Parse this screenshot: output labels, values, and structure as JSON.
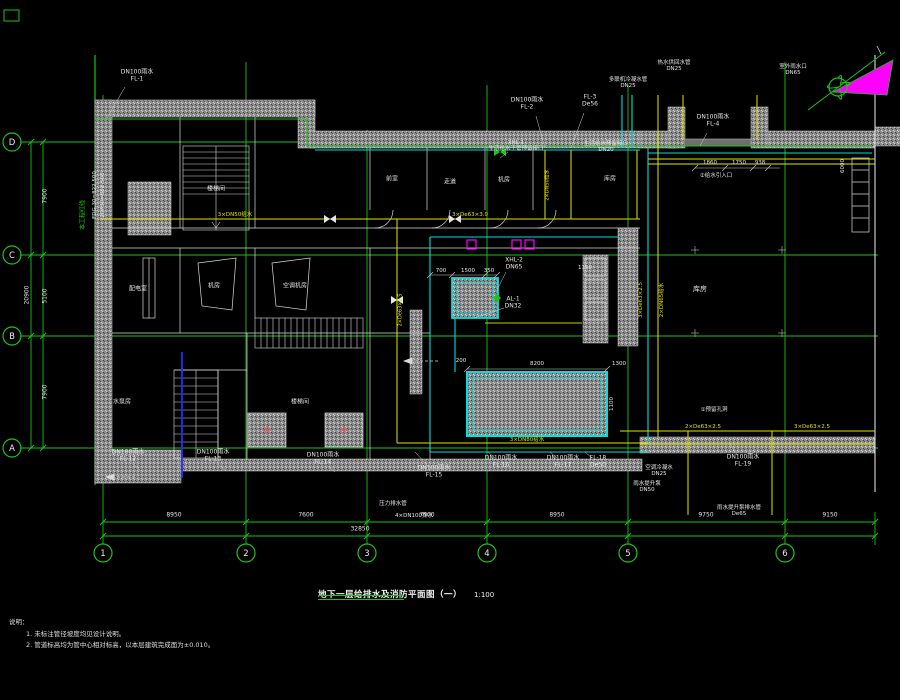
{
  "meta": {
    "title": "地下一层给排水及消防平面图（一）",
    "scale": "1:100"
  },
  "notes": {
    "heading": "说明：",
    "items": [
      "1. 未标注管径坡度均见设计说明。",
      "2. 管道标高均为管中心相对标高，以本层建筑完成面为±0.010。"
    ]
  },
  "colors": {
    "grid": "#19c519",
    "pipe_water": "#00e0e0",
    "pipe_fire": "#e3e300",
    "wall": "#8f8f8f",
    "north": "#ff00ff",
    "text": "#e6e6e6"
  },
  "grid": {
    "cols": [
      {
        "label": "1",
        "x": 103
      },
      {
        "label": "2",
        "x": 246
      },
      {
        "label": "3",
        "x": 367
      },
      {
        "label": "4",
        "x": 487
      },
      {
        "label": "5",
        "x": 628
      },
      {
        "label": "6",
        "x": 785
      }
    ],
    "rows": [
      {
        "label": "D",
        "y": 142
      },
      {
        "label": "C",
        "y": 255
      },
      {
        "label": "B",
        "y": 336
      },
      {
        "label": "A",
        "y": 448
      }
    ],
    "bubble_y": 553,
    "bubble_x": 12
  },
  "dims": {
    "bottom": [
      {
        "t": "8950",
        "x": 174
      },
      {
        "t": "7600",
        "x": 306
      },
      {
        "t": "7500",
        "x": 427
      },
      {
        "t": "8950",
        "x": 557
      },
      {
        "t": "9750",
        "x": 706
      },
      {
        "t": "9150",
        "x": 830
      }
    ],
    "bottom_total": {
      "t": "32850",
      "x": 360,
      "y": 530
    },
    "left": [
      {
        "t": "7900",
        "y": 196
      },
      {
        "t": "5100",
        "y": 296
      },
      {
        "t": "7900",
        "y": 392
      }
    ],
    "left_total": {
      "t": "20900",
      "y": 295
    },
    "white": [
      {
        "t": "8200",
        "x": 537,
        "y": 364
      },
      {
        "t": "1300",
        "x": 619,
        "y": 364
      },
      {
        "t": "200",
        "x": 461,
        "y": 361
      },
      {
        "t": "1100",
        "x": 612,
        "y": 404,
        "rot": 1
      },
      {
        "t": "700",
        "x": 441,
        "y": 271
      },
      {
        "t": "1500",
        "x": 468,
        "y": 271
      },
      {
        "t": "350",
        "x": 489,
        "y": 271
      },
      {
        "t": "1860",
        "x": 710,
        "y": 163
      },
      {
        "t": "1750",
        "x": 739,
        "y": 163
      },
      {
        "t": "938",
        "x": 760,
        "y": 163
      },
      {
        "t": "1150",
        "x": 585,
        "y": 268
      },
      {
        "t": "6000",
        "x": 843,
        "y": 166,
        "rot": 1
      }
    ]
  },
  "labels": [
    {
      "id": "label-fl1",
      "t": "DN100雨水\nFL-1",
      "x": 137,
      "y": 76,
      "c": "w",
      "leader": [
        107,
        118,
        125,
        87
      ]
    },
    {
      "id": "label-site-red-line",
      "t": "本工程红线",
      "x": 84,
      "y": 215,
      "c": "g",
      "rot": 1
    },
    {
      "id": "label-coord-1",
      "t": "FDG.30=822.500",
      "x": 95,
      "y": 195,
      "c": "w",
      "rot": 1,
      "s": 5.5
    },
    {
      "id": "label-coord-2",
      "t": "2DF30=822.500",
      "x": 103,
      "y": 195,
      "c": "w",
      "rot": 1,
      "s": 5.5
    },
    {
      "id": "label-fl2",
      "t": "DN100雨水\nFL-2",
      "x": 527,
      "y": 104,
      "c": "w",
      "leader": [
        545,
        148,
        536,
        116
      ]
    },
    {
      "id": "label-fl3",
      "t": "FL-3\nDe56",
      "x": 590,
      "y": 101,
      "c": "w",
      "leader": [
        571,
        148,
        584,
        113
      ]
    },
    {
      "id": "label-condensate",
      "t": "多联机冷凝水管\nDN25",
      "x": 628,
      "y": 83,
      "c": "w",
      "s": 5.5
    },
    {
      "id": "label-hotwater",
      "t": "热水供回水管\nDN25",
      "x": 674,
      "y": 66,
      "c": "w",
      "s": 5.5
    },
    {
      "id": "label-rain-outlet",
      "t": "室外雨水口\nDN65",
      "x": 793,
      "y": 70,
      "c": "w",
      "s": 5.5
    },
    {
      "id": "label-fl4",
      "t": "DN100雨水\nFL-4",
      "x": 713,
      "y": 121,
      "c": "w",
      "leader": [
        700,
        146,
        707,
        133
      ]
    },
    {
      "id": "label-xhl1",
      "t": "XHL-1\n生活给水干管预留接口",
      "x": 516,
      "y": 146,
      "c": "w",
      "s": 5.5,
      "leader": [
        500,
        158,
        508,
        152
      ]
    },
    {
      "id": "label-reserved-water",
      "t": "生活给水预留接口\nDN20",
      "x": 606,
      "y": 147,
      "c": "w",
      "s": 5.5
    },
    {
      "id": "label-xhl2",
      "t": "XHL-2\nDN65",
      "x": 514,
      "y": 264,
      "c": "w",
      "leader": [
        497,
        290,
        506,
        272
      ]
    },
    {
      "id": "label-al1",
      "t": "AL-1\nDN32",
      "x": 513,
      "y": 303,
      "c": "w",
      "leader": [
        474,
        318,
        504,
        308
      ]
    },
    {
      "id": "label-fl12",
      "t": "DN100雨水\nFL-12",
      "x": 128,
      "y": 456,
      "c": "w",
      "leader": [
        140,
        470,
        133,
        464
      ]
    },
    {
      "id": "label-fl13",
      "t": "DN100雨水\nFL-13",
      "x": 213,
      "y": 456,
      "c": "w",
      "leader": [
        225,
        470,
        218,
        464
      ]
    },
    {
      "id": "label-fl14",
      "t": "DN100雨水\nFL-14",
      "x": 323,
      "y": 459,
      "c": "w",
      "leader": [
        335,
        472,
        328,
        466
      ]
    },
    {
      "id": "label-fl15",
      "t": "DN100雨水\nFL-15",
      "x": 434,
      "y": 472,
      "c": "w",
      "leader": [
        415,
        452,
        428,
        466
      ]
    },
    {
      "id": "label-fl16",
      "t": "DN100雨水\nFL-16",
      "x": 501,
      "y": 462,
      "c": "w",
      "leader": [
        488,
        452,
        495,
        458
      ]
    },
    {
      "id": "label-fl17",
      "t": "DN100雨水\nFL-17",
      "x": 563,
      "y": 462,
      "c": "w",
      "leader": [
        550,
        452,
        557,
        458
      ]
    },
    {
      "id": "label-fl18",
      "t": "FL-18\nDe50",
      "x": 598,
      "y": 462,
      "c": "w",
      "leader": [
        585,
        452,
        592,
        458
      ]
    },
    {
      "id": "label-fl19",
      "t": "DN100雨水\nFL-19",
      "x": 743,
      "y": 461,
      "c": "w",
      "leader": [
        730,
        444,
        737,
        455
      ]
    },
    {
      "id": "label-ac-condensate",
      "t": "空调冷凝水\nDN25",
      "x": 659,
      "y": 471,
      "c": "w",
      "s": 5.5
    },
    {
      "id": "label-rain-pump",
      "t": "雨水提升泵\nDN50",
      "x": 647,
      "y": 487,
      "c": "w",
      "s": 5.5
    },
    {
      "id": "label-pump-drain",
      "t": "雨水提升泵排水管\nDe65",
      "x": 739,
      "y": 511,
      "c": "w",
      "s": 5.5
    },
    {
      "id": "label-pressure-drain",
      "t": "压力排水管",
      "x": 393,
      "y": 504,
      "c": "w",
      "s": 5.5
    },
    {
      "id": "label-drain4",
      "t": "4×DN100排水",
      "x": 414,
      "y": 516,
      "c": "w",
      "s": 5.5
    },
    {
      "id": "label-note-hole",
      "t": "①预留孔洞",
      "x": 714,
      "y": 410,
      "c": "w",
      "s": 5.5
    },
    {
      "id": "label-note-inlet",
      "t": "②给水引入口",
      "x": 716,
      "y": 176,
      "c": "w",
      "s": 5.5
    },
    {
      "id": "label-pipe-y1",
      "t": "3×DN50给水",
      "x": 235,
      "y": 215,
      "c": "y",
      "s": 5.5
    },
    {
      "id": "label-pipe-y2",
      "t": "3×De63×3.0",
      "x": 470,
      "y": 215,
      "c": "y",
      "s": 5.5
    },
    {
      "id": "label-pipe-y3",
      "t": "2×De63×2.5",
      "x": 703,
      "y": 427,
      "c": "y",
      "s": 5.5
    },
    {
      "id": "label-pipe-y4",
      "t": "3×De63×2.5",
      "x": 812,
      "y": 427,
      "c": "y",
      "s": 5.5
    },
    {
      "id": "label-pipe-y5",
      "t": "3×DN80给水",
      "x": 527,
      "y": 440,
      "c": "y",
      "s": 5.5
    },
    {
      "id": "label-pipe-yv1",
      "t": "3×De63×2.5",
      "x": 641,
      "y": 300,
      "c": "y",
      "rot": 1,
      "s": 5.5
    },
    {
      "id": "label-pipe-yv2",
      "t": "2×DN65给水",
      "x": 662,
      "y": 300,
      "c": "y",
      "rot": 1,
      "s": 5.5
    },
    {
      "id": "label-pipe-yv3",
      "t": "2×DN50给水",
      "x": 548,
      "y": 185,
      "c": "y",
      "rot": 1,
      "s": 5
    },
    {
      "id": "label-pipe-yv4",
      "t": "2×De63×2.5",
      "x": 401,
      "y": 310,
      "c": "y",
      "rot": 1,
      "s": 5
    },
    {
      "id": "room-stair-1",
      "t": "楼梯间",
      "x": 216,
      "y": 190,
      "c": "w"
    },
    {
      "id": "room-front",
      "t": "前室",
      "x": 392,
      "y": 180,
      "c": "w"
    },
    {
      "id": "room-corridor",
      "t": "走道",
      "x": 450,
      "y": 183,
      "c": "w"
    },
    {
      "id": "room-plant",
      "t": "机房",
      "x": 504,
      "y": 181,
      "c": "w"
    },
    {
      "id": "room-store-1",
      "t": "库房",
      "x": 610,
      "y": 180,
      "c": "w"
    },
    {
      "id": "room-hall",
      "t": "库房",
      "x": 700,
      "y": 290,
      "c": "w",
      "s": 7
    },
    {
      "id": "room-power",
      "t": "配电室",
      "x": 138,
      "y": 290,
      "c": "w"
    },
    {
      "id": "room-plant-2",
      "t": "机房",
      "x": 214,
      "y": 287,
      "c": "w"
    },
    {
      "id": "room-ac",
      "t": "空调机房",
      "x": 295,
      "y": 287,
      "c": "w"
    },
    {
      "id": "room-pump",
      "t": "水泵房",
      "x": 122,
      "y": 403,
      "c": "w"
    },
    {
      "id": "room-stair-2",
      "t": "楼梯间",
      "x": 300,
      "y": 403,
      "c": "w"
    }
  ]
}
